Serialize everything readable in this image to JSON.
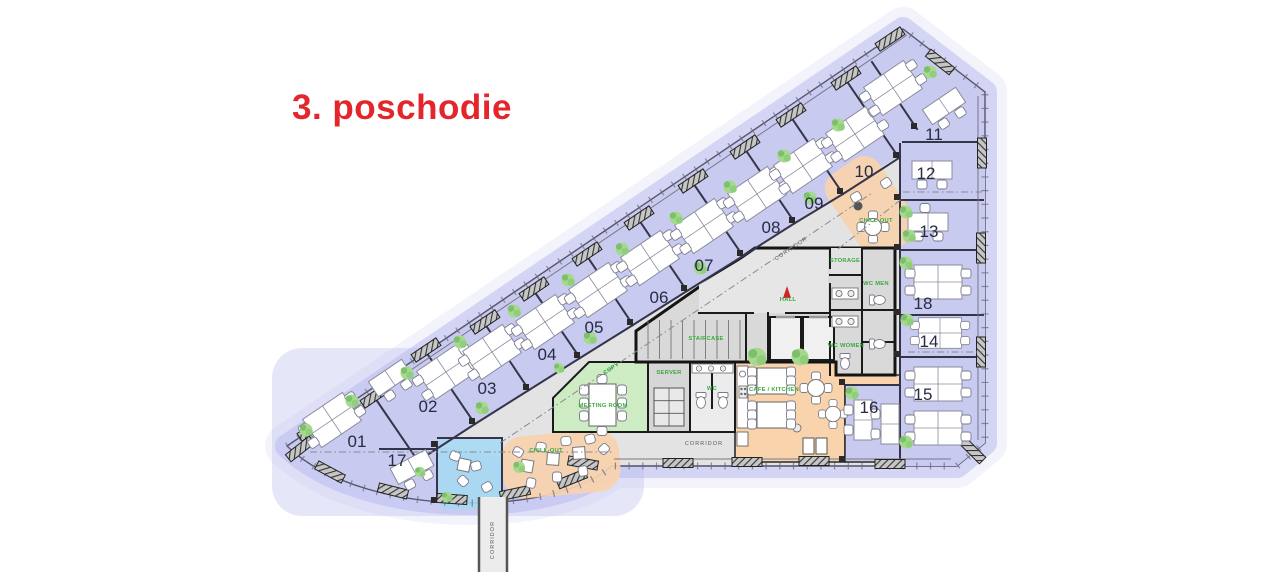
{
  "title": "3. poschodie",
  "colors": {
    "title_red": "#e4252b",
    "room_lavender": "#c9caf0",
    "halo_lavender": "#b6b7ee",
    "core_gray": "#d9d9d9",
    "center_gray": "#e3e3e3",
    "meeting_green": "#cdecc3",
    "zone_orange": "#f8d3ac",
    "zone_blue": "#a5d9f2",
    "label_green": "#3aa93f",
    "wall_dark": "#1a1a1a"
  },
  "plan": {
    "room_numbers": [
      "01",
      "02",
      "03",
      "04",
      "05",
      "06",
      "07",
      "08",
      "09",
      "10",
      "11",
      "12",
      "13",
      "14",
      "15",
      "16",
      "17",
      "18"
    ],
    "zones": {
      "staircase": "STAIRCASE",
      "hall": "HALL",
      "storage": "STORAGE",
      "wc_men": "WC MEN",
      "wc_women": "WC WOMEN",
      "wc_small": "WC",
      "meeting_room": "MEETING ROOM",
      "server": "SERVER",
      "copy": "COPY",
      "cafe_kitchen": "CAFE / KITCHEN",
      "chill_out_top": "CHILL-OUT",
      "chill_out_bottom": "CHILL-OUT",
      "corridor_diagonal": "CORRIDOR",
      "corridor_bottom": "CORRIDOR",
      "corridor_stub": "CORRIDOR"
    }
  }
}
